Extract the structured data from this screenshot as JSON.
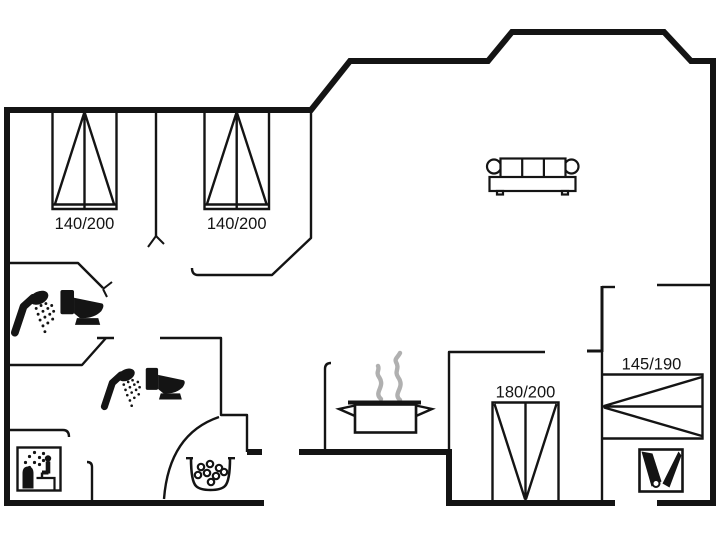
{
  "floorplan": {
    "type": "holiday-home-floor-plan",
    "background_color": "#ffffff",
    "wall_color": "#141414",
    "steam_color": "#b0b0b0",
    "bed_labels": {
      "bedroom1": "140/200",
      "bedroom2": "140/200",
      "bedroom3": "180/200",
      "bunk": "145/190"
    },
    "icons": [
      "double-bed",
      "double-bed",
      "double-bed",
      "bunk-bed",
      "shower-and-toilet",
      "shower-and-toilet",
      "sauna",
      "whirlpool-tub",
      "cooking-pot-with-steam",
      "sofa",
      "cleaning-equipment"
    ]
  }
}
